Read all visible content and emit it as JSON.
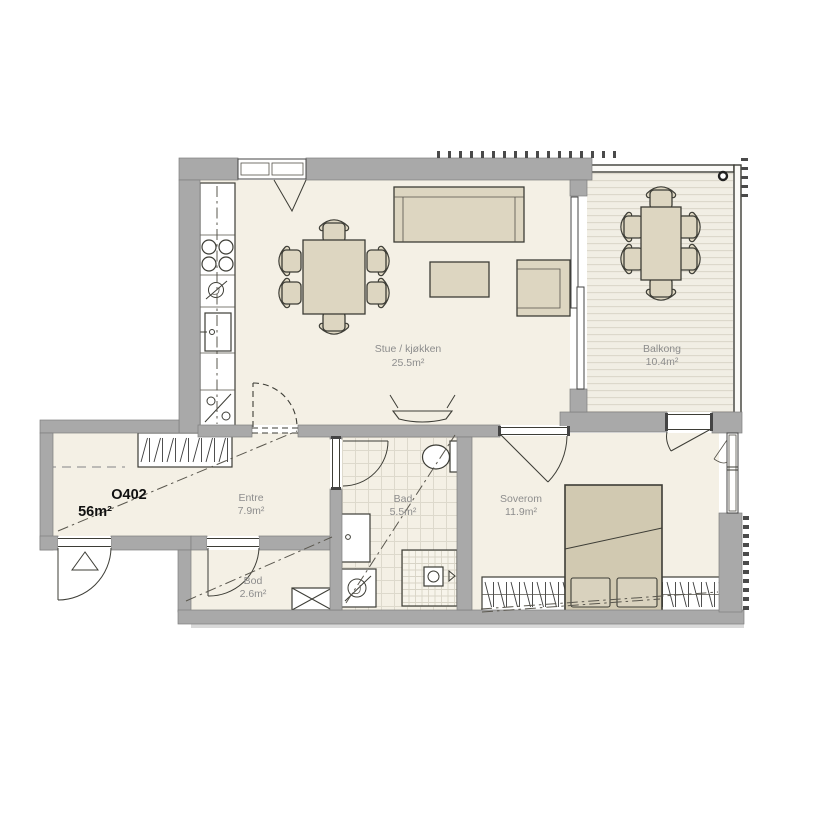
{
  "plan": {
    "unit": {
      "id": "O402",
      "area": "56m²"
    },
    "rooms": {
      "stue": {
        "name": "Stue / kjøkken",
        "area": "25.5m²"
      },
      "balkong": {
        "name": "Balkong",
        "area": "10.4m²"
      },
      "soverom": {
        "name": "Soverom",
        "area": "11.9m²"
      },
      "bad": {
        "name": "Bad",
        "area": "5.5m²"
      },
      "entre": {
        "name": "Entre",
        "area": "7.9m²"
      },
      "bod": {
        "name": "Bod",
        "area": "2.6m²"
      }
    },
    "colors": {
      "wall": "#a9a9a9",
      "floor": "#f4f0e5",
      "furniture": "#ddd6c1",
      "bed": "#d1c9b1",
      "outline": "#3d3d36",
      "room_label": "#8d8d8d",
      "unit_label": "#111111",
      "background": "#ffffff"
    }
  }
}
